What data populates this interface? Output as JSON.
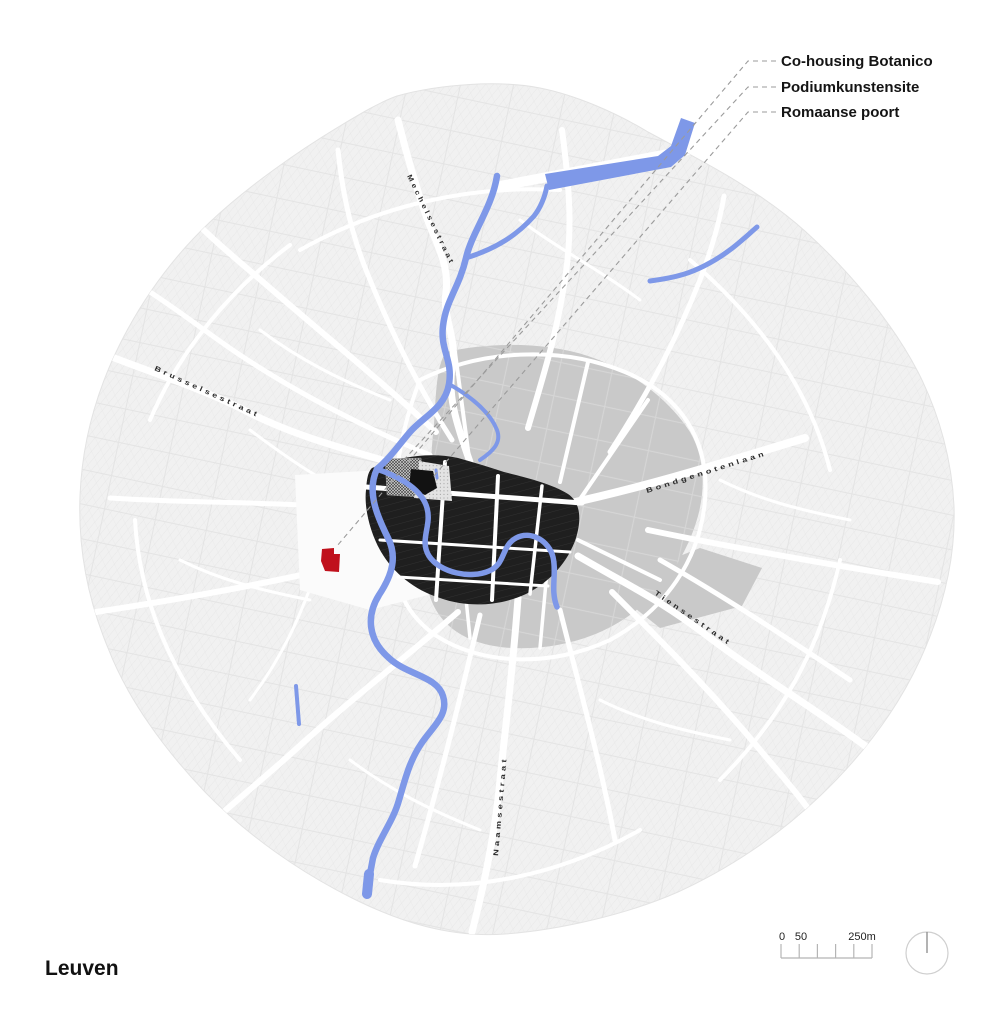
{
  "title": "Leuven",
  "annotations": {
    "items": [
      {
        "label": "Co-housing Botanico"
      },
      {
        "label": "Podiumkunstensite"
      },
      {
        "label": "Romaanse poort"
      }
    ]
  },
  "streets": {
    "labels": [
      {
        "name": "Mechelsestraat"
      },
      {
        "name": "Brusselsestraat"
      },
      {
        "name": "Bondgenotenlaan"
      },
      {
        "name": "Tiensestraat"
      },
      {
        "name": "Naamsestraat"
      }
    ]
  },
  "scalebar": {
    "ticks": [
      "0",
      "50",
      "250m"
    ]
  },
  "colors": {
    "fabric": "#F1F1F1",
    "inner_blocks": "#C9C9C9",
    "core_blocks": "#1F1F1F",
    "water": "#7E98E8",
    "site_highlight": "#C0111C",
    "leader_line": "#9B9B9B"
  }
}
